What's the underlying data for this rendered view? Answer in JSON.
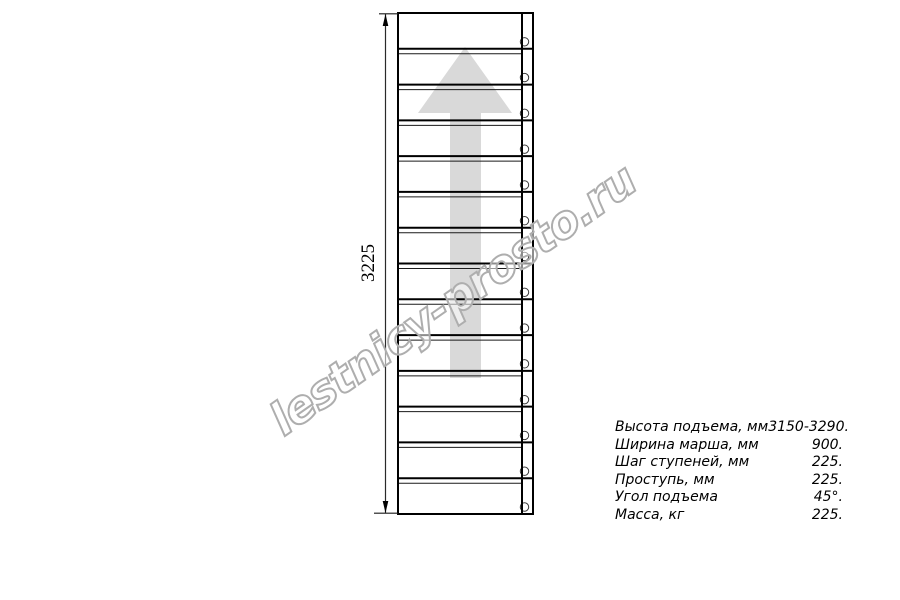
{
  "drawing": {
    "type": "staircase-plan-view",
    "dimension_label": "3225",
    "steps_count": 14,
    "watermark_text": "lestnicy-prosto.ru",
    "geometry": {
      "left": 398,
      "top": 13,
      "right": 533,
      "bottom": 514,
      "stringer_divider_x": 522,
      "tread_thin_line_offset": 5,
      "fastener_cx": 524.5,
      "fastener_r": 4.2,
      "fastener_offset_above_edge": 7,
      "dim_line_x": 385.5,
      "dim_ext_top_left": 379,
      "dim_ext_bottom_left": 374
    },
    "arrow_points": "465,47 512,113 481,113 481,378 450,378 450,113 418,113",
    "colors": {
      "line": "#000000",
      "thin_line": "#1a1a1a",
      "arrow_fill": "#d9d9d9",
      "watermark_stroke": "#aeaeae",
      "circle_stroke": "#3a3a3a"
    }
  },
  "specs": {
    "rows": [
      {
        "label": "Высота подъема, мм",
        "value": "3150-3290."
      },
      {
        "label": "Ширина марша, мм",
        "value": "900."
      },
      {
        "label": "Шаг ступеней, мм",
        "value": "225."
      },
      {
        "label": "Проступь, мм",
        "value": "225."
      },
      {
        "label": "Угол подъема",
        "value": "45°."
      },
      {
        "label": "Масса, кг",
        "value": "225."
      }
    ]
  }
}
